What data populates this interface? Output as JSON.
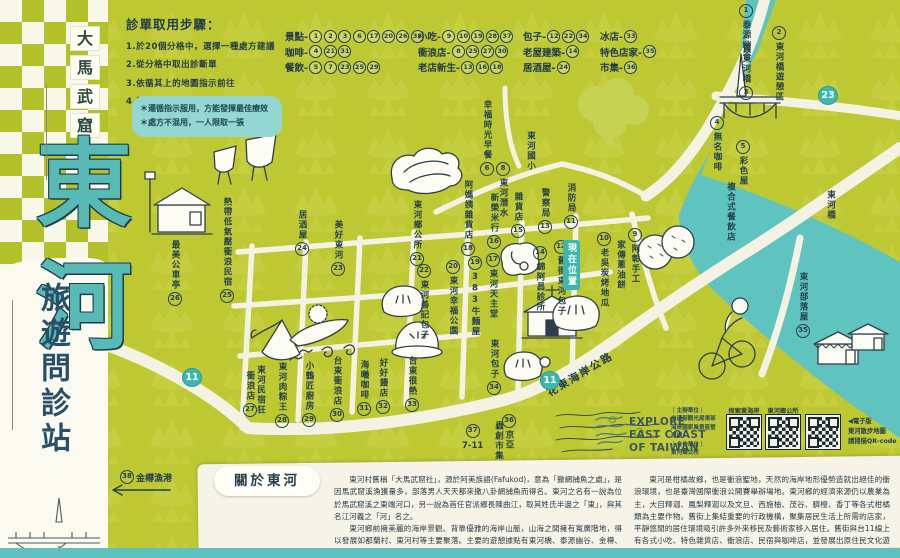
{
  "colors": {
    "green": "#bdc832",
    "teal": "#5fc3bf",
    "accent": "#3eb6b1",
    "navy": "#24404e",
    "road": "#f4f2e3",
    "paper": "#f6f4e8"
  },
  "sidebar": {
    "top_title_chars": [
      "大",
      "馬",
      "武",
      "窟"
    ],
    "main_title_chars": [
      "東",
      "河"
    ],
    "subtitle": "旅遊問診站"
  },
  "instructions": {
    "title": "診單取用步驟：",
    "steps": [
      "1.於20個分格中，選擇一種處方建議",
      "2.從分格中取出診斷單",
      "3.依循其上的地圖指示前往",
      "4.即可獲得舒緩症狀的良帖藥方"
    ],
    "notes": [
      "＊遵循指示服用，方能發揮最佳療效",
      "＊處方不混用，一人限取一張"
    ]
  },
  "legend": {
    "columns": [
      {
        "x": 285,
        "rows": [
          {
            "label": "景點-",
            "numbers": [
              "1",
              "2",
              "3",
              "6",
              "17",
              "20",
              "26",
              "38"
            ]
          },
          {
            "label": "咖啡-",
            "numbers": [
              "4",
              "21",
              "31"
            ]
          },
          {
            "label": "餐飲-",
            "numbers": [
              "5",
              "7",
              "23",
              "25",
              "29"
            ]
          }
        ]
      },
      {
        "x": 418,
        "rows": [
          {
            "label": "小吃-",
            "numbers": [
              "9",
              "10",
              "19",
              "28",
              "37"
            ]
          },
          {
            "label": "衝浪店-",
            "numbers": [
              "8",
              "25",
              "27",
              "30"
            ]
          },
          {
            "label": "老店新生-",
            "numbers": [
              "13",
              "16",
              "18"
            ]
          }
        ]
      },
      {
        "x": 523,
        "rows": [
          {
            "label": "包子-",
            "numbers": [
              "12",
              "22",
              "34"
            ]
          },
          {
            "label": "老屋建築-",
            "numbers": [
              "14"
            ]
          },
          {
            "label": "居酒屋-",
            "numbers": [
              "24"
            ]
          }
        ]
      },
      {
        "x": 600,
        "rows": [
          {
            "label": "冰店-",
            "numbers": [
              "33"
            ]
          },
          {
            "label": "特色店家-",
            "numbers": [
              "35"
            ]
          },
          {
            "label": "市集-",
            "numbers": [
              "36"
            ]
          }
        ]
      }
    ]
  },
  "map": {
    "you_are_here": "現在位置",
    "road_label": "花東海岸公路",
    "route_badges": [
      {
        "num": "11",
        "x": 182,
        "y": 368
      },
      {
        "num": "11",
        "x": 540,
        "y": 371
      },
      {
        "num": "23",
        "x": 818,
        "y": 86
      }
    ],
    "labels": [
      {
        "num": "1",
        "text": "泰源幽谷",
        "x": 739,
        "y": 2,
        "numFirst": true
      },
      {
        "num": "2",
        "text": "東河橋遊憩區",
        "x": 772,
        "y": 24,
        "numFirst": true
      },
      {
        "num": "3",
        "text": "舊東河橋",
        "x": 739,
        "y": 44
      },
      {
        "num": "4",
        "text": "無名咖啡",
        "x": 710,
        "y": 114,
        "numFirst": true
      },
      {
        "num": "5",
        "text": "彩色屋",
        "x": 736,
        "y": 138,
        "numFirst": true
      },
      {
        "text": "複合式餐飲店",
        "x": 726,
        "y": 182
      },
      {
        "num": "6",
        "text": "幸福時光早餐",
        "x": 480,
        "y": 100
      },
      {
        "text": "東河國小",
        "x": 526,
        "y": 131
      },
      {
        "num": "8",
        "text": "東河潛水",
        "x": 496,
        "y": 160,
        "numFirst": true
      },
      {
        "num": "21",
        "text": "東河鄉公所",
        "x": 410,
        "y": 200
      },
      {
        "num": "18",
        "text": "阿媽姨雜貨店",
        "x": 461,
        "y": 180
      },
      {
        "num": "16",
        "text": "新榮米行",
        "x": 487,
        "y": 193
      },
      {
        "num": "15",
        "text": "雜貨店",
        "x": 511,
        "y": 192
      },
      {
        "num": "13",
        "text": "警察局",
        "x": 538,
        "y": 188
      },
      {
        "num": "11",
        "text": "消防局",
        "x": 564,
        "y": 183
      },
      {
        "num": "9",
        "text": "阿彰手工",
        "x": 628,
        "y": 226,
        "numFirst": true
      },
      {
        "text": "家傳蔥油餅",
        "x": 616,
        "y": 240
      },
      {
        "num": "10",
        "text": "老吳炭烤地瓜",
        "x": 597,
        "y": 230,
        "numFirst": true
      },
      {
        "num": "12",
        "text": "舊街東河包子",
        "x": 554,
        "y": 238,
        "numFirst": true
      },
      {
        "num": "14",
        "text": "錦阿昌診所",
        "x": 533,
        "y": 244,
        "numFirst": true
      },
      {
        "num": "17",
        "text": "東河天主堂",
        "x": 486,
        "y": 251,
        "numFirst": true
      },
      {
        "num": "19",
        "text": "383牛麵屋",
        "x": 468,
        "y": 254,
        "numFirst": true
      },
      {
        "num": "20",
        "text": "東河幸福公園",
        "x": 446,
        "y": 258,
        "numFirst": true
      },
      {
        "num": "22",
        "text": "東河善記包子",
        "x": 417,
        "y": 262,
        "numFirst": true
      },
      {
        "num": "23",
        "text": "美好東河",
        "x": 331,
        "y": 220
      },
      {
        "num": "24",
        "text": "居酒屋",
        "x": 295,
        "y": 210
      },
      {
        "num": "25",
        "text": "熱帶低氣壓衝浪民宿",
        "x": 220,
        "y": 197
      },
      {
        "num": "26",
        "text": "最美公車亭",
        "x": 168,
        "y": 240
      },
      {
        "text": "東河民宿狂",
        "x": 256,
        "y": 365
      },
      {
        "num": "27",
        "text": "衝浪店",
        "x": 243,
        "y": 371
      },
      {
        "num": "28",
        "text": "東河肉粽王",
        "x": 275,
        "y": 362
      },
      {
        "num": "29",
        "text": "小鶴匠廚房",
        "x": 302,
        "y": 361
      },
      {
        "num": "30",
        "text": "台東衝浪店",
        "x": 330,
        "y": 356
      },
      {
        "num": "31",
        "text": "海曦咖啡",
        "x": 357,
        "y": 360
      },
      {
        "num": "32",
        "text": "好好饅店",
        "x": 376,
        "y": 358
      },
      {
        "num": "33",
        "text": "台東很熱",
        "x": 405,
        "y": 356
      },
      {
        "num": "34",
        "text": "東河包子",
        "x": 487,
        "y": 339
      },
      {
        "num": "35",
        "text": "東河部落屋",
        "x": 796,
        "y": 272
      },
      {
        "num": "36",
        "text": "京亞",
        "x": 502,
        "y": 412,
        "numFirst": true
      },
      {
        "text": "蟲創市集",
        "x": 494,
        "y": 421
      },
      {
        "num": "37",
        "text": "7-11",
        "x": 462,
        "y": 422,
        "stacked": true
      },
      {
        "num": "38",
        "text": "金樽漁港",
        "x": 120,
        "y": 468,
        "horizontal": true,
        "numFirst": true
      },
      {
        "text": "東河橋",
        "x": 826,
        "y": 190
      }
    ]
  },
  "about": {
    "title": "關於東河",
    "col1_p1": "東河村舊稱「大馬武窟社」，源於阿美族語(Fafukod)，意為「撒網捕魚之處」，是因馬武窟溪漁獲量多，部落男人天天都來撒八卦網捕魚而得名。東河之名有一說為位於馬武窟溪之東端河口，另一說為首任官派鄉長陳曲江，取其姓氏半邊之「東」，與其名江河義之「河」名之。",
    "col1_p2": "東河鄉前擁美麗的海岸景觀、背靠優雅的海岸山脈，山海之間擁有寬廣階地，得以發展如都蘭村、東河村等主要聚落。主要的遊憩據點有東河橋、泰源幽谷、金樽、都蘭、水往上流等，還有縣定古蹟都蘭遺址以及歷史建築舊東河橋、新東糖廠等豐富此區之文化氛圍。",
    "col2_p1": "東河是柑橘故鄉，也是衝浪聖地，天然的海岸地形優勢造就出絕佳的衝浪環境，也是臺灣國際衝浪公開賽舉辦場地。東河鄉的經濟來源仍以農業為主，大目釋迦、鳳梨釋迦以及文旦、西施柚、茂谷、臍橙、香丁等各式柑橘類為主要作物。舊街上集結重要的行政機構，聚集居民生活上所需的店家，平靜悠閒的居住環境吸引許多外來移民及藝術家移入居住。舊街與台11線上有各式小吃、特色雜貨店、衝浪店、民宿與咖啡店，並發展出原住民文化遊程。在東河舊街悠閒的散步、沿路走走，處處是景色，也是最愜意美好的遊玩方式。"
  },
  "footer": {
    "logo_lines": [
      "EXPLORE",
      "EAST COAST",
      "OF TAIWAN"
    ],
    "org_label": "｜主辦單位｜",
    "org_name": "交通部觀光局東部海岸國家風景區管理處",
    "partner_label": "｜合作單位｜",
    "partner_name": "東河鄉公所",
    "qr_codes": [
      {
        "label": "探索東海岸"
      },
      {
        "label": "東河鄉公所"
      },
      {
        "label": ""
      }
    ],
    "eversion_lines": [
      "◀電子版",
      "東河散步地圖",
      "請掃描QR-code"
    ]
  }
}
